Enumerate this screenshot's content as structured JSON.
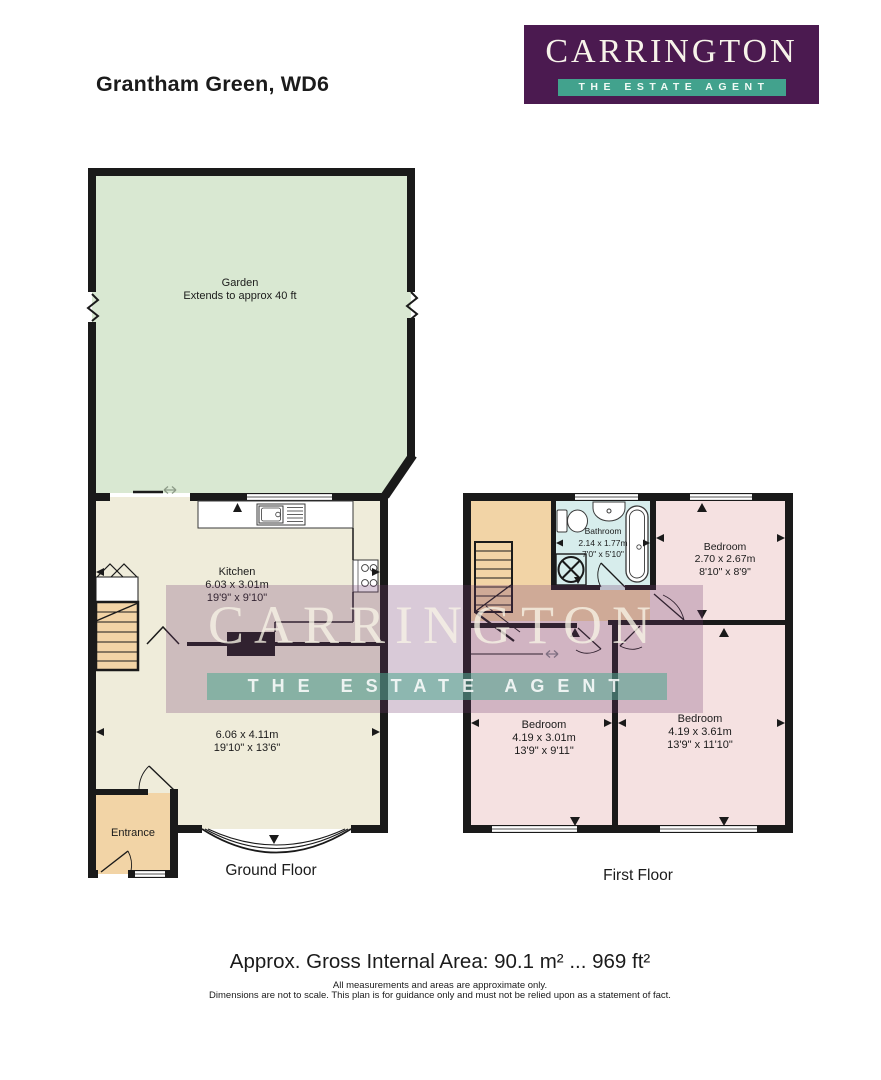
{
  "page": {
    "title": "Grantham Green, WD6"
  },
  "logo": {
    "name": "CARRINGTON",
    "tagline": "THE ESTATE AGENT"
  },
  "garden": {
    "name": "Garden",
    "note": "Extends to approx 40 ft"
  },
  "ground_floor": {
    "label": "Ground Floor",
    "rooms": {
      "kitchen": {
        "name": "Kitchen",
        "metric": "6.03 x 3.01m",
        "imperial": "19'9\" x 9'10\""
      },
      "reception": {
        "metric": "6.06 x 4.11m",
        "imperial": "19'10\" x 13'6\""
      },
      "entrance": {
        "name": "Entrance"
      }
    }
  },
  "first_floor": {
    "label": "First Floor",
    "rooms": {
      "bathroom": {
        "name": "Bathroom",
        "metric": "2.14 x 1.77m",
        "imperial": "7'0\" x 5'10\""
      },
      "bedroom_rear": {
        "name": "Bedroom",
        "metric": "2.70 x 2.67m",
        "imperial": "8'10\" x 8'9\""
      },
      "bedroom_left": {
        "name": "Bedroom",
        "metric": "4.19 x 3.01m",
        "imperial": "13'9\" x 9'11\""
      },
      "bedroom_right": {
        "name": "Bedroom",
        "metric": "4.19 x 3.61m",
        "imperial": "13'9\" x 11'10\""
      }
    }
  },
  "footer": {
    "area": "Approx. Gross Internal Area: 90.1 m² ... 969 ft²",
    "disclaimer1": "All measurements and areas are approximate only.",
    "disclaimer2": "Dimensions are not to scale. This plan is for guidance only and must not be relied upon as a statement of fact."
  },
  "colors": {
    "brand_purple": "#4b1a50",
    "brand_teal": "#42a28d",
    "garden_green": "#d9e8d2",
    "floor_cream": "#efecda",
    "floor_pink": "#f5e1e1",
    "accent_tan": "#f2d4a6",
    "bathroom_blue": "#d7edec",
    "wall_black": "#1a1a1a"
  }
}
